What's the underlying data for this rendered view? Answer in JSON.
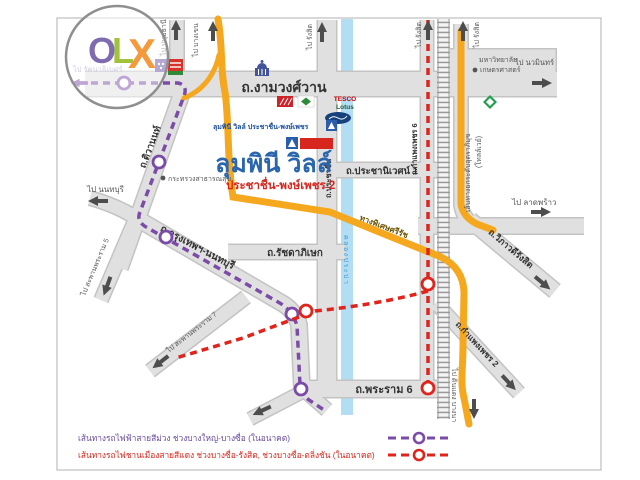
{
  "colors": {
    "purple_line": "#7B4BA8",
    "red_line": "#E0241C",
    "expressway_yellow": "#F5A81E",
    "canal_blue": "#B3DDF2",
    "road_fill": "#E0E0E0",
    "title_blue": "#2A66AD",
    "accent_red": "#D6261D"
  },
  "watermark": {
    "o": "O",
    "l": "L",
    "x": "X"
  },
  "project": {
    "marker_label": "ลุมพินี วิลล์ ประชาชื่น-พงษ์เพชร",
    "title": "ลุมพินี วิลล์",
    "subtitle": "ประชาชื่น-พงษ์เพชร 2"
  },
  "roads": {
    "ngamwongwan": "ถ.งามวงศ์วาน",
    "tiwanon": "ถ.ติวานนท์",
    "prachachuen": "ถ.ประชาชื่น",
    "prachaniwet1": "ถ.ประชานิเวศน์ 1",
    "ratchadaphisek": "ถ.รัชดาภิเษก",
    "krungthep_nonthaburi": "ถ.กรุงเทพฯ-นนทบุรี",
    "rama6": "ถ.พระราม 6",
    "kamphaengphet6": "ถ.กำแพงเพชร 6",
    "kamphaengphet2": "ถ.กำแพงเพชร 2",
    "vibhavadi_rangsit": "ถ.วิภาวดีรังสิต",
    "tollway_line1": "เส้นทางยกระดับอุตราภิมุข",
    "tollway_line2": "(โทลล์เวย์)",
    "sirat_expressway": "ทางพิเศษศรีรัช",
    "prapa_canal": "คลองประปา"
  },
  "directions": {
    "rattanathibet": "ไป รัตนาธิเบศร์",
    "pathumthani": "ไป ปทุมธานี",
    "bangkhen": "ไป บางเขน",
    "rangsit": "ไป รังสิต",
    "nawamin": "ไป นวมินทร์",
    "latphrao": "ไป ลาดพร้าว",
    "nonthaburi": "ไป นนทบุรี",
    "rama5_bridge": "ไป สะพานพระราม 5",
    "rama7_bridge": "ไป สะพานพระราม 7",
    "dindaeng_bangna": "ไป ดินแดง บางนา"
  },
  "landmarks": {
    "moph": "กระทรวงสาธารณสุข",
    "ku_line1": "มหาวิทยาลัย",
    "ku_line2": "เกษตรศาสตร์",
    "tesco": "TESCO",
    "lotus": "Lotus"
  },
  "legend": {
    "purple": "เส้นทางรถไฟฟ้าสายสีม่วง ช่วงบางใหญ่-บางซื่อ (ในอนาคต)",
    "red": "เส้นทางรถไฟชานเมืองสายสีแดง ช่วงบางซื่อ-รังสิต, ช่วงบางซื่อ-ตลิ่งชัน (ในอนาคต)"
  }
}
